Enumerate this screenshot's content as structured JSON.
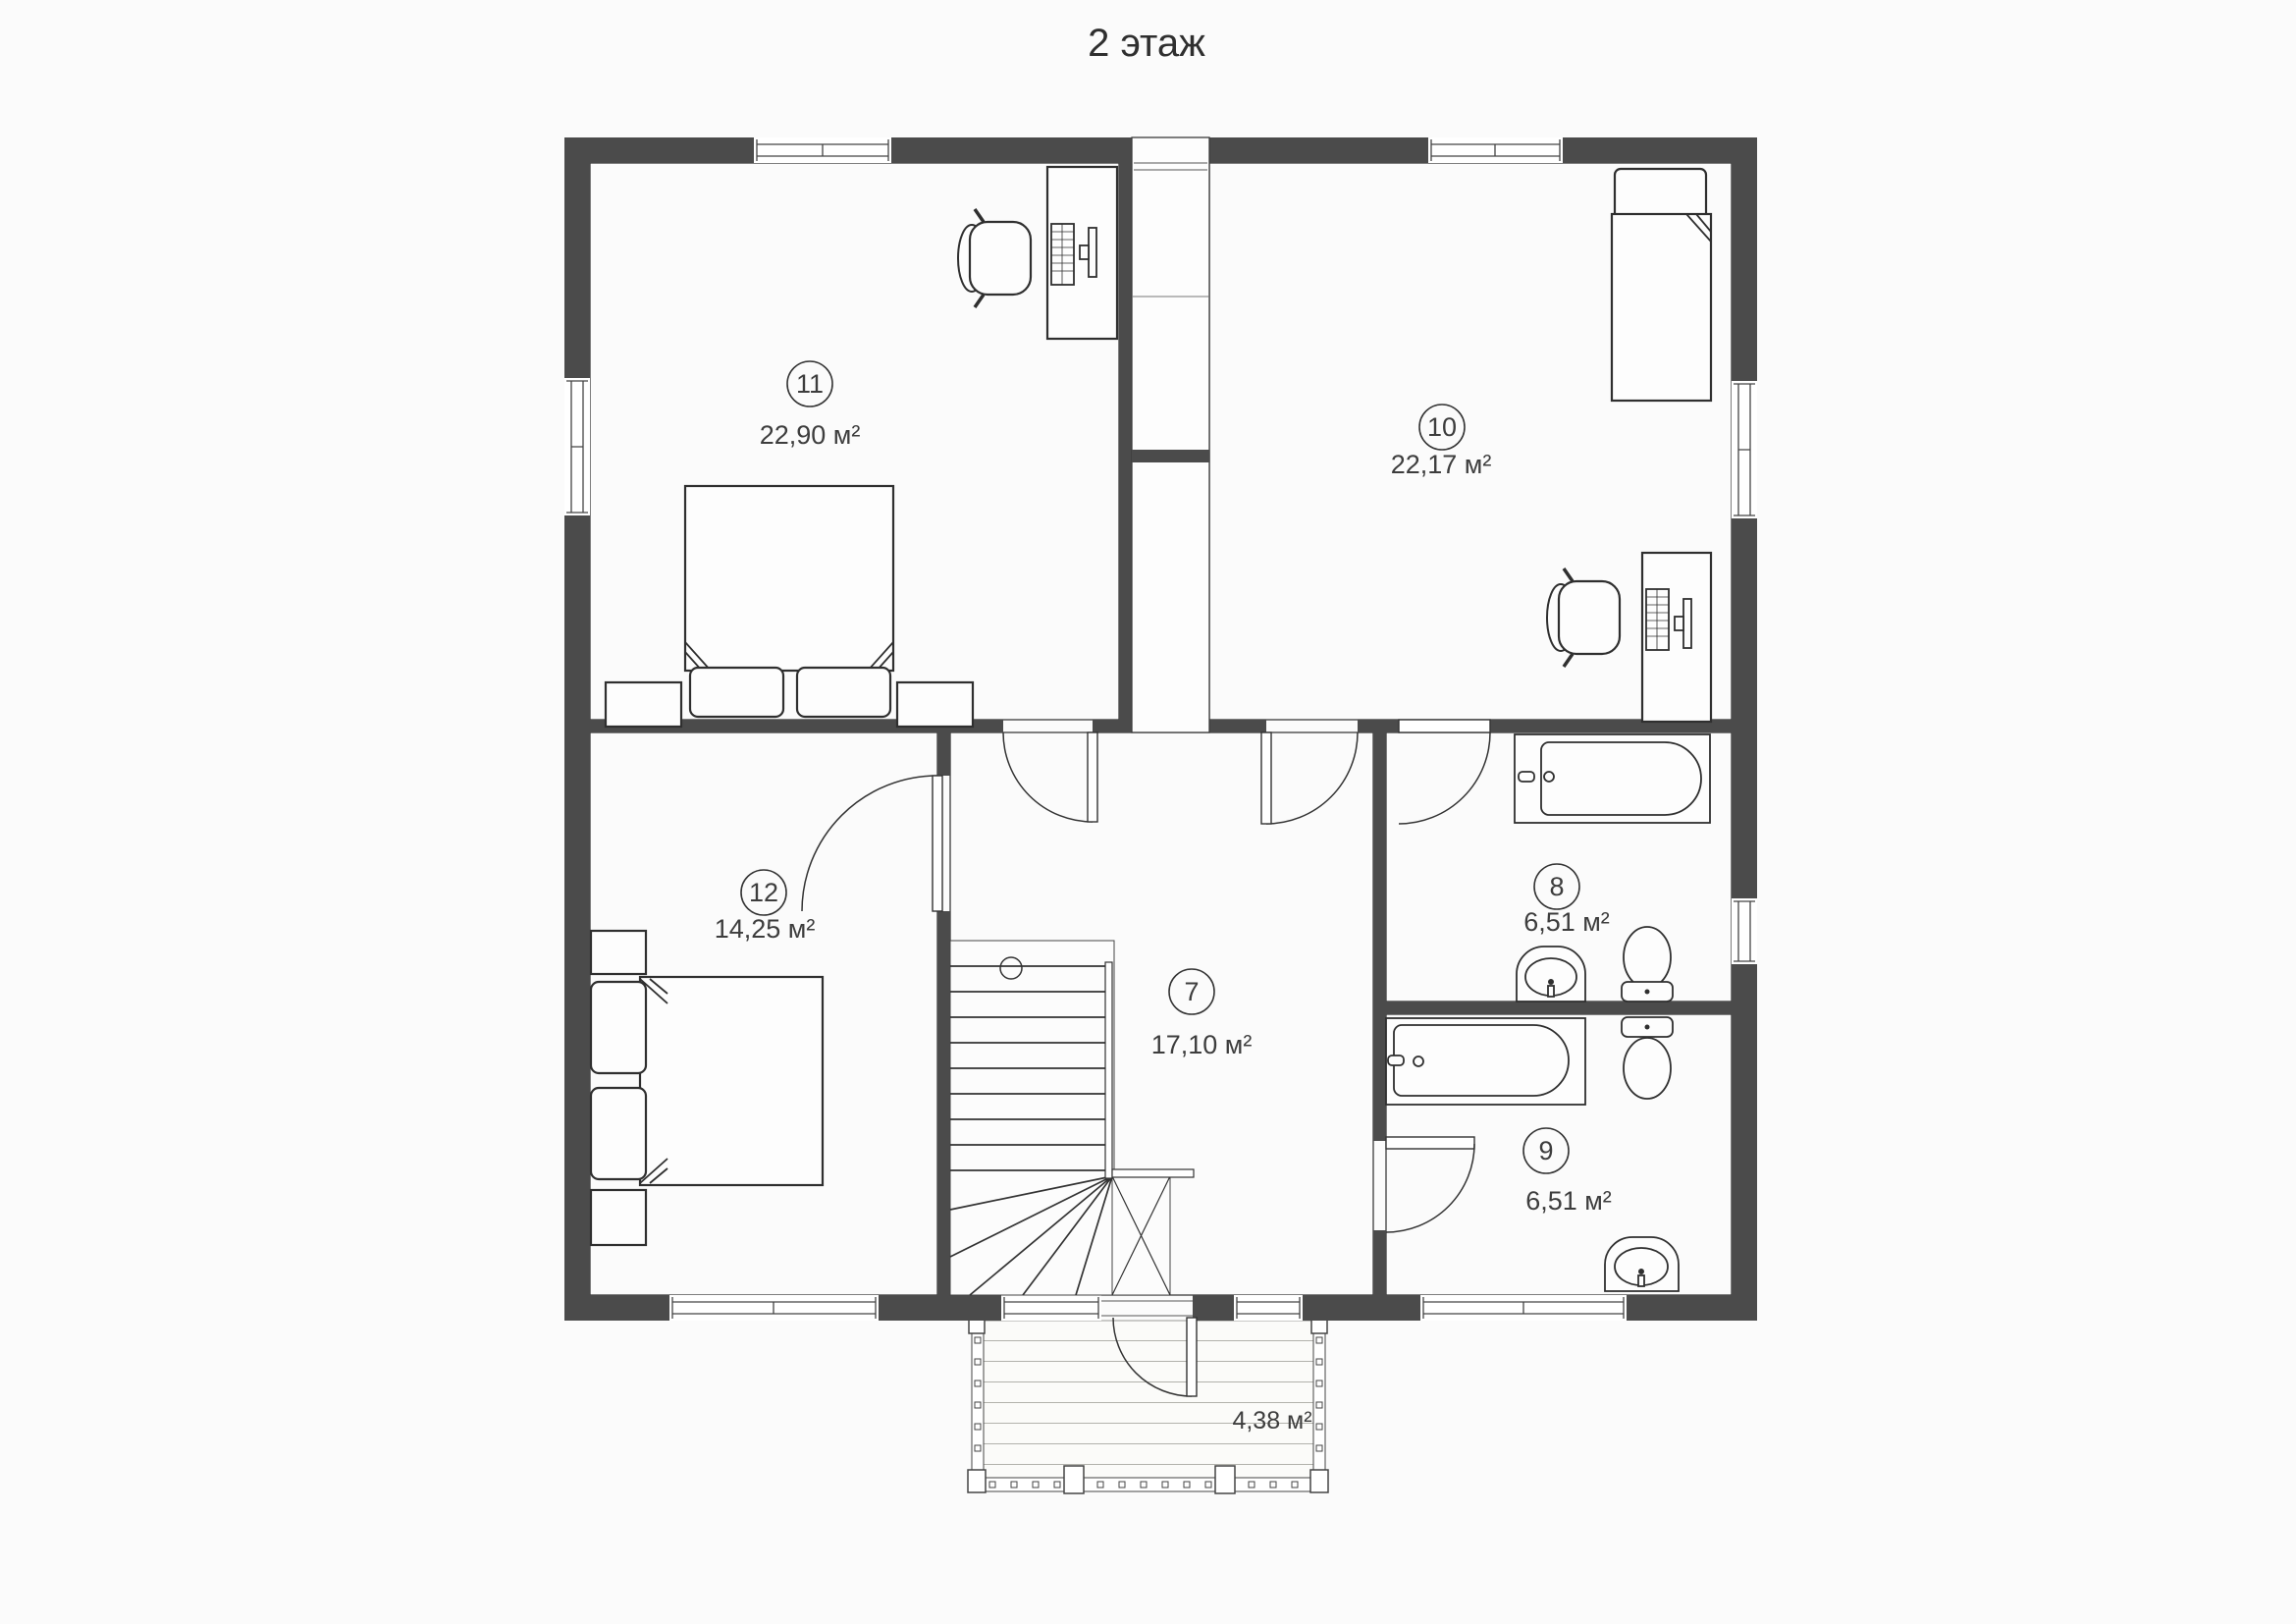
{
  "title": "2 этаж",
  "floor_plan": {
    "rooms": [
      {
        "number": "11",
        "area": "22,90 м²"
      },
      {
        "number": "10",
        "area": "22,17 м²"
      },
      {
        "number": "12",
        "area": "14,25 м²"
      },
      {
        "number": "7",
        "area": "17,10 м²"
      },
      {
        "number": "8",
        "area": "6,51 м²"
      },
      {
        "number": "9",
        "area": "6,51 м²"
      }
    ],
    "balcony": {
      "area": "4,38 м²"
    },
    "colors": {
      "wall": "#4b4b4b",
      "parquet_line": "#a59f85",
      "hall_plank_line": "#5f5b52",
      "hall_chevron": "#b6ad9c",
      "tile_line": "#bfc8d2",
      "text": "#3d3d3d"
    }
  }
}
